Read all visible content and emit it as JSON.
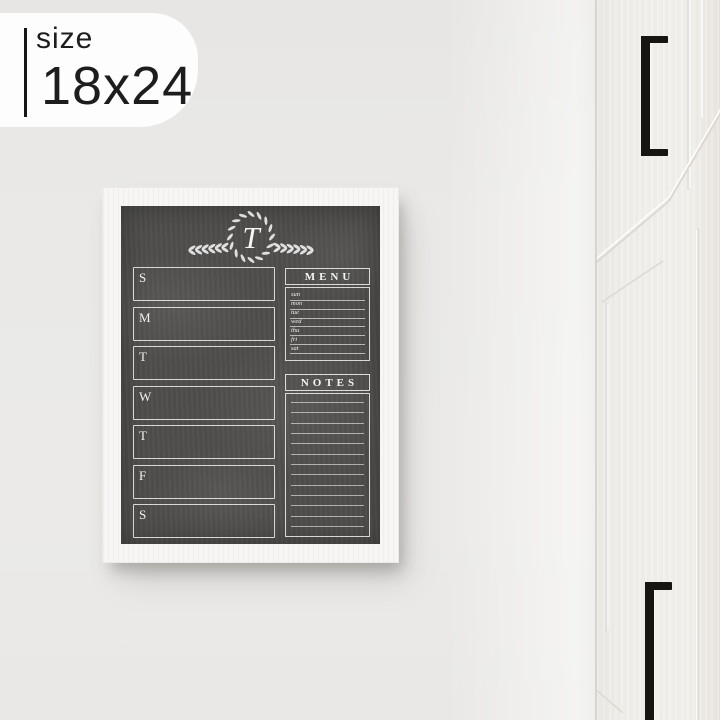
{
  "size_badge": {
    "label": "size",
    "value": "18x24"
  },
  "planner": {
    "monogram_letter": "T",
    "days": [
      "S",
      "M",
      "T",
      "W",
      "T",
      "F",
      "S"
    ],
    "menu": {
      "title": "MENU",
      "day_labels": [
        "sun",
        "mon",
        "tue",
        "wed",
        "thu",
        "fri",
        "sat"
      ]
    },
    "notes": {
      "title": "NOTES",
      "line_count": 13
    }
  },
  "colors": {
    "wall": "#e9e8e6",
    "frame": "#f7f6f4",
    "chalkboard": "#4f4e4d",
    "chalk_line": "#ffffff",
    "cabinet": "#f1efeb",
    "handle": "#171511"
  }
}
